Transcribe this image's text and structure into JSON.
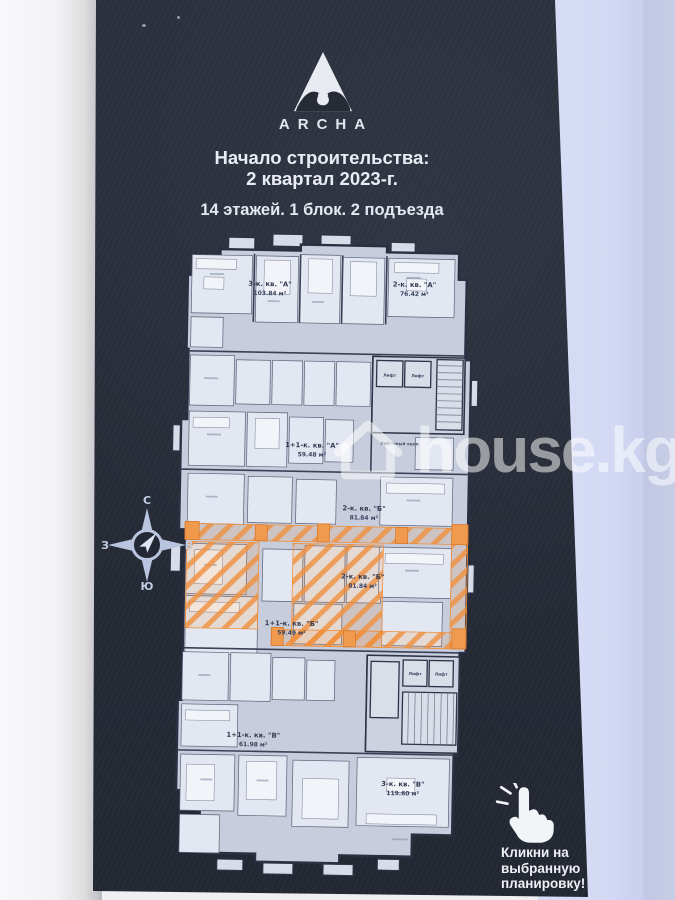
{
  "poster": {
    "brand": "ARCHA",
    "start_line1": "Начало строительства:",
    "start_line2": "2 квартал 2023-г.",
    "building_info": "14 этажей. 1 блок. 2 подъезда",
    "cta_line1": "Кликни на",
    "cta_line2": "выбранную",
    "cta_line3": "планировку!"
  },
  "compass": {
    "north": "С",
    "east": "В",
    "south": "Ю",
    "west": "З"
  },
  "watermark": {
    "site": "house.kg"
  },
  "floor_plan": {
    "highlight_color": "#ef8f3c",
    "elevator_label": "Лифт",
    "elevator_hall_label": "Лифтовый холл",
    "apartments": [
      {
        "name": "3-к. кв. \"А\"",
        "area": "103.84 м²",
        "highlighted": false
      },
      {
        "name": "2-к. кв. \"А\"",
        "area": "76.42 м²",
        "highlighted": false
      },
      {
        "name": "1+1-к. кв. \"А\"",
        "area": "59.48 м²",
        "highlighted": false
      },
      {
        "name": "2-к. кв. \"Б\"",
        "area": "81.84 м²",
        "highlighted": false
      },
      {
        "name": "2-к. кв. \"Б\"",
        "area": "81.84 м²",
        "highlighted": true
      },
      {
        "name": "1+1-к. кв. \"Б\"",
        "area": "59.49 м²",
        "highlighted": true
      },
      {
        "name": "1+1-к. кв. \"В\"",
        "area": "61.98 м²",
        "highlighted": false
      },
      {
        "name": "3-к. кв. \"В\"",
        "area": "119.60 м²",
        "highlighted": false
      }
    ]
  }
}
